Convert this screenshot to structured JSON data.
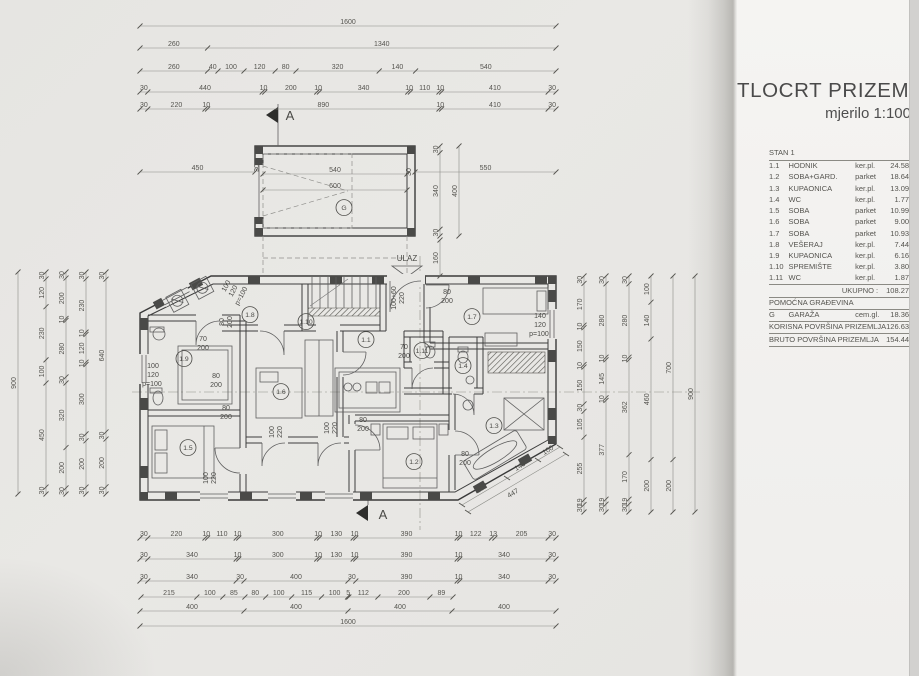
{
  "panel": {
    "title": "TLOCRT PRIZEMLJA",
    "subtitle": "mjerilo 1:100",
    "table_header": "STAN 1",
    "rooms": [
      {
        "num": "1.1",
        "name": "HODNIK",
        "floor": "ker.pl.",
        "area": "24.58 m²"
      },
      {
        "num": "1.2",
        "name": "SOBA+GARD.",
        "floor": "parket",
        "area": "18.64 m²"
      },
      {
        "num": "1.3",
        "name": "KUPAONICA",
        "floor": "ker.pl.",
        "area": "13.09 m²"
      },
      {
        "num": "1.4",
        "name": "WC",
        "floor": "ker.pl.",
        "area": "1.77 m²"
      },
      {
        "num": "1.5",
        "name": "SOBA",
        "floor": "parket",
        "area": "10.99 m²"
      },
      {
        "num": "1.6",
        "name": "SOBA",
        "floor": "parket",
        "area": "9.00 m²"
      },
      {
        "num": "1.7",
        "name": "SOBA",
        "floor": "parket",
        "area": "10.93 m²"
      },
      {
        "num": "1.8",
        "name": "VEŠERAJ",
        "floor": "ker.pl.",
        "area": "7.44 m²"
      },
      {
        "num": "1.9",
        "name": "KUPAONICA",
        "floor": "ker.pl.",
        "area": "6.16 m²"
      },
      {
        "num": "1.10",
        "name": "SPREMIŠTE",
        "floor": "ker.pl.",
        "area": "3.80 m²"
      },
      {
        "num": "1.11",
        "name": "WC",
        "floor": "ker.pl.",
        "area": "1.87 m²"
      }
    ],
    "summary": [
      {
        "type": "total",
        "label": "UKUPNO :",
        "value": "108.27 m²"
      },
      {
        "type": "section",
        "label": "POMOĆNA GRAĐEVINA"
      },
      {
        "type": "room",
        "num": "G",
        "name": "GARAŽA",
        "floor": "cem.gl.",
        "value": "18.36 m²"
      },
      {
        "type": "total2",
        "label": "KORISNA POVRŠINA PRIZEMLJA",
        "value": "126.63 m²"
      },
      {
        "type": "total2",
        "label": "BRUTO POVRŠINA PRIZEMLJA",
        "value": "154.44 m²"
      }
    ]
  },
  "plan": {
    "section_letter": "A",
    "entrance_label": "ULAZ",
    "chains": [
      {
        "o": "h",
        "p": 26,
        "a": 140,
        "b": 556,
        "v": [
          "1600"
        ]
      },
      {
        "o": "h",
        "p": 48,
        "a": 140,
        "b": 556,
        "v": [
          "260",
          "1340"
        ]
      },
      {
        "o": "h",
        "p": 71,
        "a": 140,
        "b": 556,
        "v": [
          "260",
          "40",
          "100",
          "120",
          "80",
          "320",
          "140",
          "540"
        ]
      },
      {
        "o": "h",
        "p": 92,
        "a": 140,
        "b": 556,
        "v": [
          "30",
          "440",
          "10",
          "200",
          "10",
          "340",
          "10",
          "110",
          "10",
          "410",
          "30"
        ]
      },
      {
        "o": "h",
        "p": 109,
        "a": 140,
        "b": 556,
        "v": [
          "30",
          "220",
          "10",
          "890",
          "10",
          "410",
          "30"
        ]
      },
      {
        "o": "h",
        "p": 538,
        "a": 140,
        "b": 556,
        "v": [
          "30",
          "220",
          "10",
          "110",
          "10",
          "300",
          "10",
          "130",
          "10",
          "390",
          "10",
          "122",
          "13",
          "205",
          "30"
        ]
      },
      {
        "o": "h",
        "p": 559,
        "a": 140,
        "b": 556,
        "v": [
          "30",
          "340",
          "10",
          "300",
          "10",
          "130",
          "10",
          "390",
          "10",
          "340",
          "30"
        ]
      },
      {
        "o": "h",
        "p": 581,
        "a": 140,
        "b": 556,
        "v": [
          "30",
          "340",
          "30",
          "400",
          "30",
          "390",
          "10",
          "340",
          "30"
        ]
      },
      {
        "o": "h",
        "p": 597,
        "a": 141,
        "b": 453,
        "v": [
          "215",
          "100",
          "85",
          "80",
          "100",
          "115",
          "100",
          "5",
          "112",
          "200",
          "89"
        ]
      },
      {
        "o": "h",
        "p": 611,
        "a": 140,
        "b": 556,
        "v": [
          "400",
          "400",
          "400",
          "400"
        ]
      },
      {
        "o": "h",
        "p": 626,
        "a": 140,
        "b": 556,
        "v": [
          "1600"
        ]
      },
      {
        "o": "h",
        "p": 172,
        "a": 140,
        "b": 255,
        "v": [
          "450"
        ]
      },
      {
        "o": "h",
        "p": 172,
        "a": 415,
        "b": 556,
        "v": [
          "550"
        ]
      },
      {
        "o": "h",
        "p": 174,
        "a": 263,
        "b": 407,
        "v": [
          "540"
        ]
      },
      {
        "o": "h",
        "p": 190,
        "a": 263,
        "b": 407,
        "v": [
          "600"
        ]
      },
      {
        "o": "v",
        "p": 18,
        "a": 272,
        "b": 494,
        "v": [
          "900"
        ]
      },
      {
        "o": "v",
        "p": 46,
        "a": 272,
        "b": 494,
        "v": [
          "30",
          "120",
          "230",
          "100",
          "450",
          "30"
        ]
      },
      {
        "o": "v",
        "p": 66,
        "a": 272,
        "b": 494,
        "v": [
          "30",
          "200",
          "10",
          "280",
          "30",
          "320",
          "200",
          "30"
        ]
      },
      {
        "o": "v",
        "p": 86,
        "a": 272,
        "b": 494,
        "v": [
          "30",
          "230",
          "10",
          "120",
          "10",
          "300",
          "30",
          "200",
          "30"
        ]
      },
      {
        "o": "v",
        "p": 106,
        "a": 272,
        "b": 494,
        "v": [
          "30",
          "640",
          "30",
          "200",
          "30"
        ]
      },
      {
        "o": "v",
        "p": 584,
        "a": 276,
        "b": 512,
        "v": [
          "30",
          "170",
          "10",
          "150",
          "10",
          "150",
          "30",
          "105",
          "255",
          "19",
          "30"
        ]
      },
      {
        "o": "v",
        "p": 606,
        "a": 276,
        "b": 512,
        "v": [
          "30",
          "280",
          "10",
          "145",
          "10",
          "377",
          "19",
          "30"
        ]
      },
      {
        "o": "v",
        "p": 629,
        "a": 276,
        "b": 512,
        "v": [
          "30",
          "280",
          "10",
          "362",
          "170",
          "19",
          "30"
        ]
      },
      {
        "o": "v",
        "p": 651,
        "a": 276,
        "b": 512,
        "v": [
          "100",
          "140",
          "460",
          "200"
        ]
      },
      {
        "o": "v",
        "p": 673,
        "a": 276,
        "b": 512,
        "v": [
          "700",
          "200"
        ]
      },
      {
        "o": "v",
        "p": 695,
        "a": 276,
        "b": 512,
        "v": [
          "900"
        ]
      },
      {
        "o": "v",
        "p": 440,
        "a": 146,
        "b": 236,
        "v": [
          "30",
          "340",
          "30"
        ]
      },
      {
        "o": "v",
        "p": 459,
        "a": 146,
        "b": 236,
        "v": [
          "400"
        ]
      },
      {
        "o": "v",
        "p": 440,
        "a": 240,
        "b": 276,
        "v": [
          "160"
        ]
      }
    ],
    "labels": [
      {
        "t": "ULAZ",
        "x": 407,
        "y": 261,
        "fs": 8
      },
      {
        "t": "A",
        "x": 290,
        "y": 120,
        "fs": 13
      },
      {
        "t": "A",
        "x": 383,
        "y": 519,
        "fs": 13
      },
      {
        "t": "G",
        "x": 344,
        "y": 210,
        "c": true
      },
      {
        "t": "30",
        "x": 259,
        "y": 168,
        "r": -90
      },
      {
        "t": "30",
        "x": 411,
        "y": 172,
        "r": -90
      },
      {
        "t": "1.1",
        "x": 366,
        "y": 342,
        "c": true
      },
      {
        "t": "1.2",
        "x": 414,
        "y": 464,
        "c": true
      },
      {
        "t": "1.3",
        "x": 494,
        "y": 428,
        "c": true
      },
      {
        "t": "1.4",
        "x": 463,
        "y": 368,
        "c": true
      },
      {
        "t": "1.5",
        "x": 188,
        "y": 450,
        "c": true
      },
      {
        "t": "1.6",
        "x": 281,
        "y": 394,
        "c": true
      },
      {
        "t": "1.7",
        "x": 472,
        "y": 319,
        "c": true
      },
      {
        "t": "1.8",
        "x": 250,
        "y": 317,
        "c": true
      },
      {
        "t": "1.9",
        "x": 184,
        "y": 361,
        "c": true
      },
      {
        "t": "1.10",
        "x": 306,
        "y": 324,
        "c": true
      },
      {
        "t": "1.11",
        "x": 422,
        "y": 353,
        "c": true
      },
      {
        "t": "70",
        "x": 203,
        "y": 341
      },
      {
        "t": "200",
        "x": 203,
        "y": 350
      },
      {
        "t": "70",
        "x": 404,
        "y": 349
      },
      {
        "t": "200",
        "x": 404,
        "y": 358
      },
      {
        "t": "80",
        "x": 224,
        "y": 322,
        "r": -90
      },
      {
        "t": "200",
        "x": 232,
        "y": 322,
        "r": -90
      },
      {
        "t": "80",
        "x": 216,
        "y": 378
      },
      {
        "t": "200",
        "x": 216,
        "y": 387
      },
      {
        "t": "80",
        "x": 226,
        "y": 410
      },
      {
        "t": "200",
        "x": 226,
        "y": 419
      },
      {
        "t": "80",
        "x": 447,
        "y": 294
      },
      {
        "t": "200",
        "x": 447,
        "y": 303
      },
      {
        "t": "80",
        "x": 363,
        "y": 422
      },
      {
        "t": "200",
        "x": 363,
        "y": 431
      },
      {
        "t": "80",
        "x": 465,
        "y": 456
      },
      {
        "t": "200",
        "x": 465,
        "y": 465
      },
      {
        "t": "100",
        "x": 153,
        "y": 368
      },
      {
        "t": "120",
        "x": 153,
        "y": 377
      },
      {
        "t": "p=100",
        "x": 152,
        "y": 386
      },
      {
        "t": "140",
        "x": 540,
        "y": 318
      },
      {
        "t": "120",
        "x": 540,
        "y": 327
      },
      {
        "t": "p=100",
        "x": 539,
        "y": 336
      },
      {
        "t": "100",
        "x": 228,
        "y": 287,
        "r": -62
      },
      {
        "t": "120",
        "x": 235,
        "y": 292,
        "r": -62
      },
      {
        "t": "p=100",
        "x": 243,
        "y": 297,
        "r": -62
      },
      {
        "t": "100+60",
        "x": 396,
        "y": 298,
        "r": -90
      },
      {
        "t": "220",
        "x": 404,
        "y": 298,
        "r": -90
      },
      {
        "t": "100",
        "x": 274,
        "y": 432,
        "r": -90
      },
      {
        "t": "220",
        "x": 282,
        "y": 432,
        "r": -90
      },
      {
        "t": "100",
        "x": 329,
        "y": 428,
        "r": -90
      },
      {
        "t": "220",
        "x": 337,
        "y": 428,
        "r": -90
      },
      {
        "t": "100",
        "x": 208,
        "y": 478,
        "r": -90
      },
      {
        "t": "220",
        "x": 216,
        "y": 478,
        "r": -90
      },
      {
        "t": "207",
        "x": 483,
        "y": 490,
        "r": -31
      },
      {
        "t": "140",
        "x": 521,
        "y": 468,
        "r": -31
      },
      {
        "t": "100",
        "x": 549,
        "y": 452,
        "r": -31
      },
      {
        "t": "447",
        "x": 514,
        "y": 495,
        "r": -31
      }
    ]
  }
}
